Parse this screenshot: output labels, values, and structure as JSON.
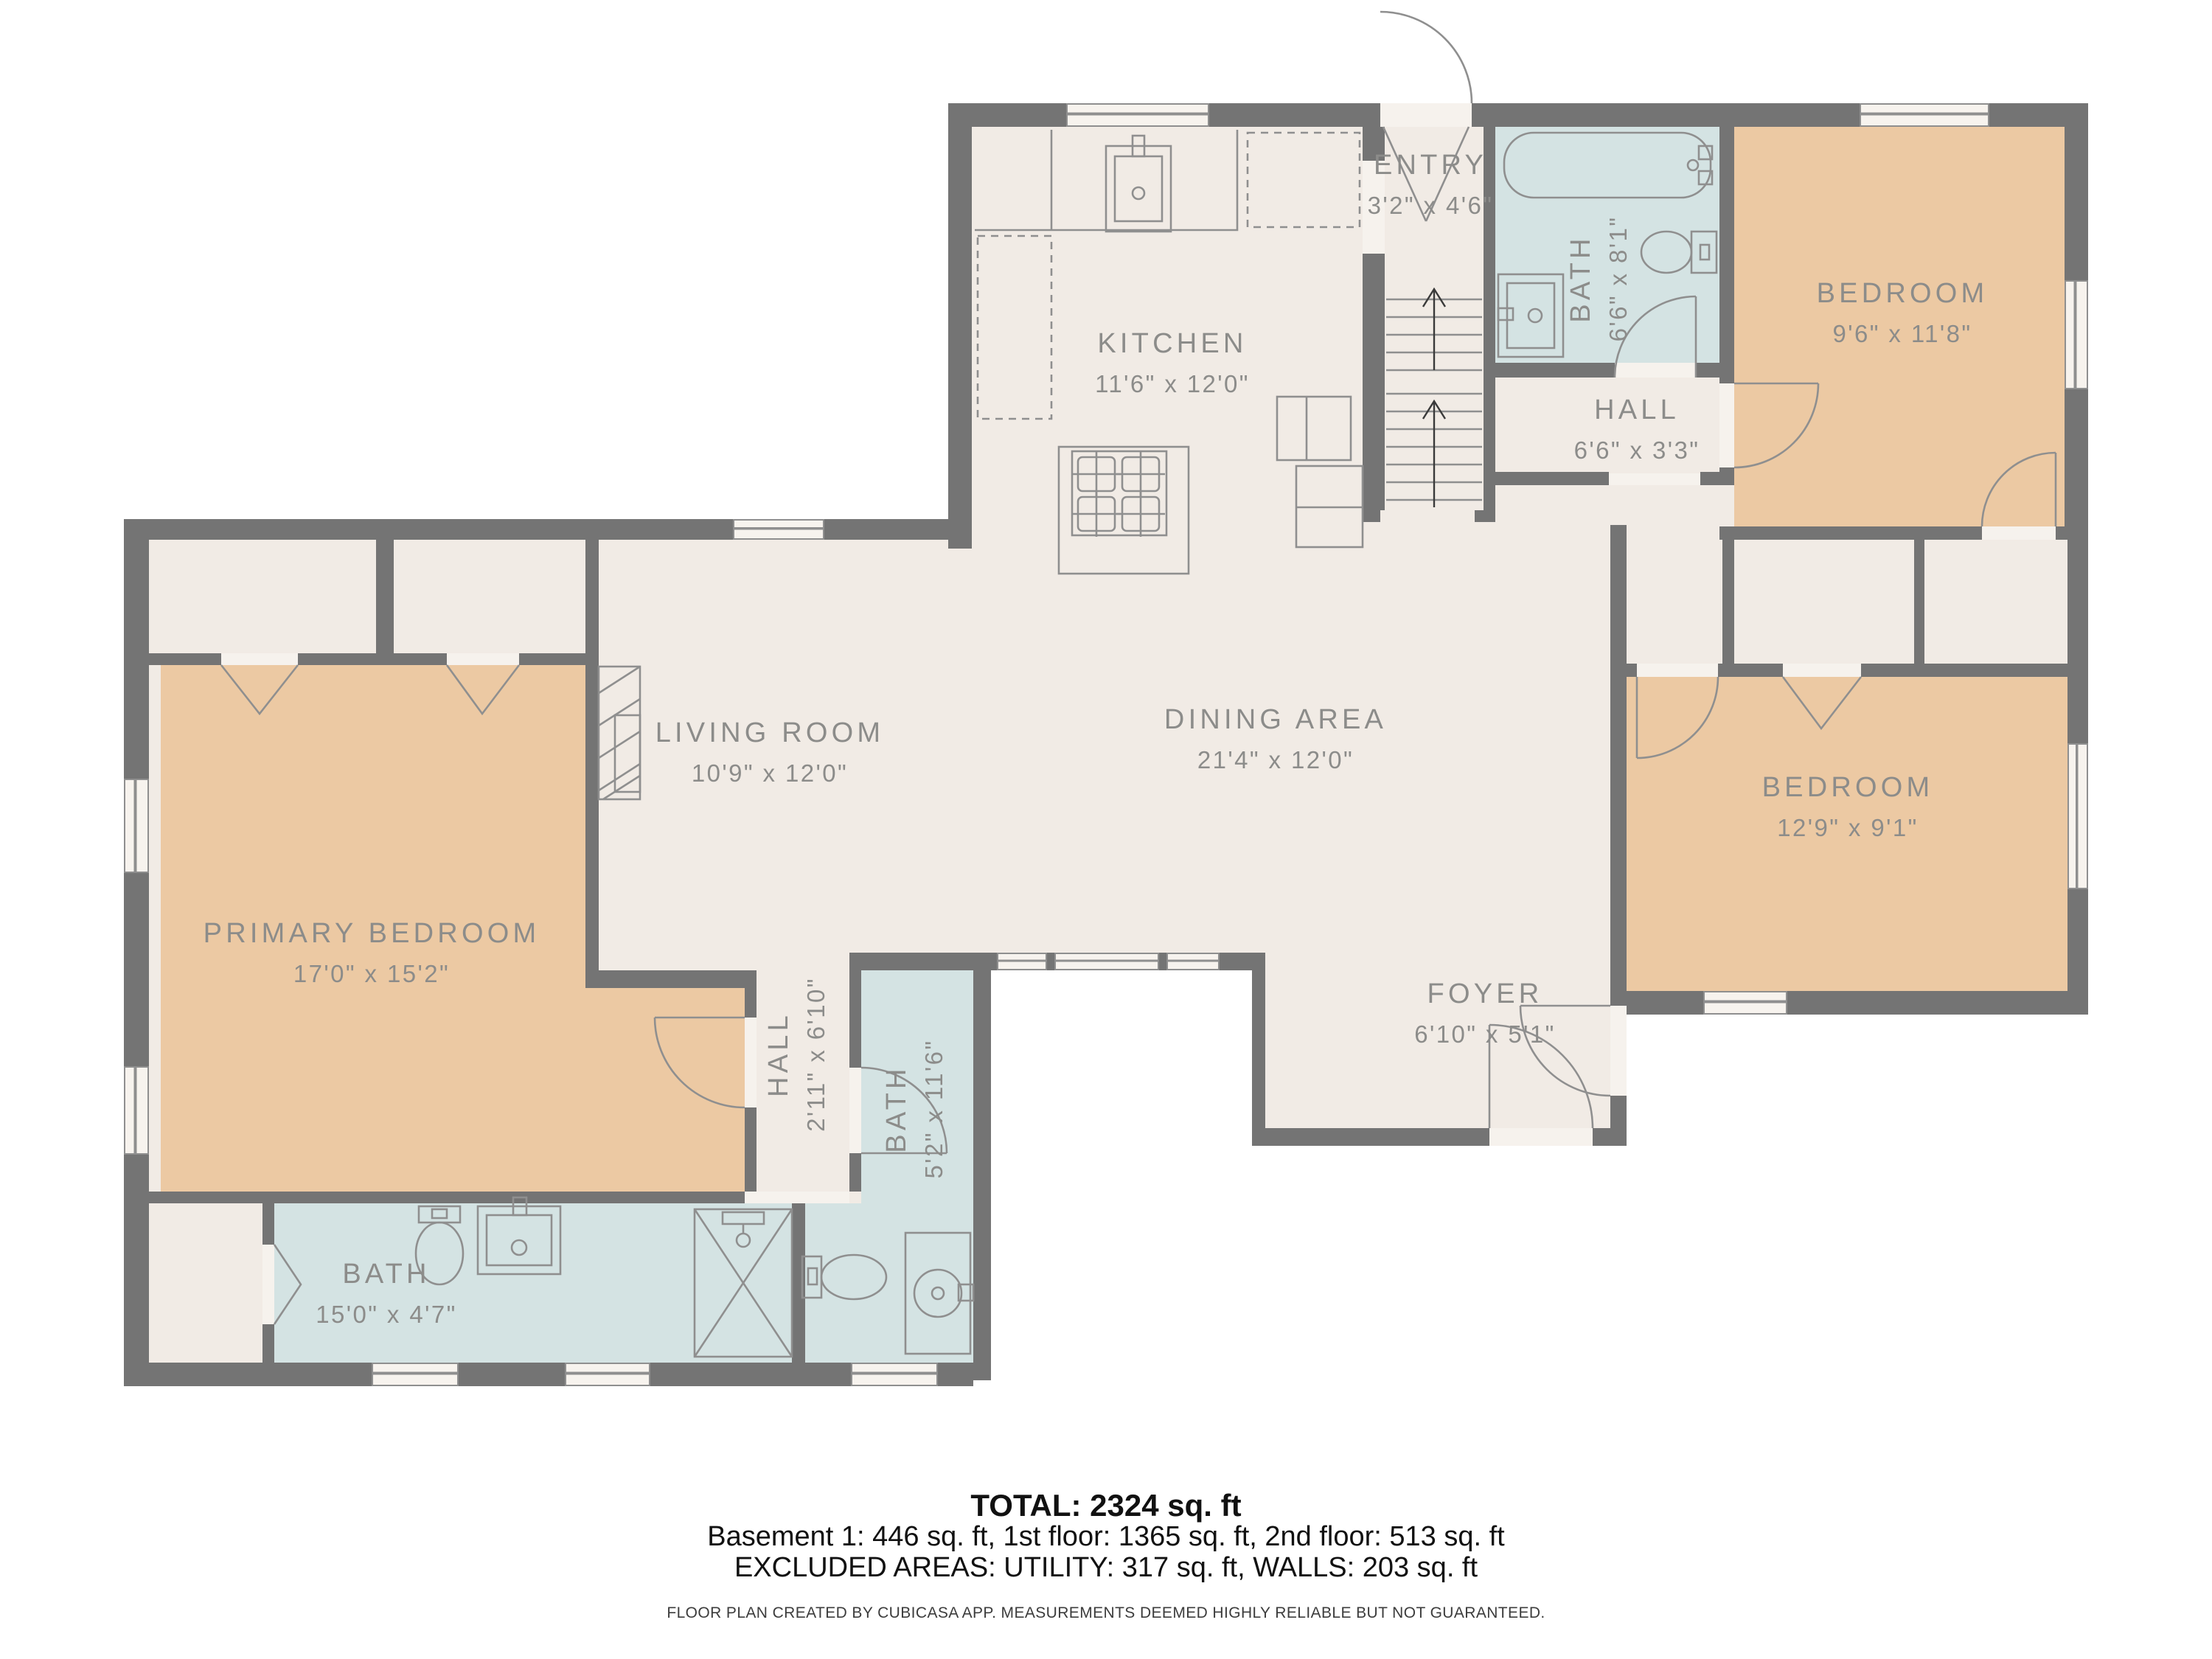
{
  "plan": {
    "rooms": {
      "kitchen": {
        "name": "KITCHEN",
        "dims": "11'6\" x 12'0\""
      },
      "entry": {
        "name": "ENTRY",
        "dims": "3'2\" x 4'6\""
      },
      "bath1": {
        "name": "BATH",
        "dims": "6'6\" x 8'1\""
      },
      "hall1": {
        "name": "HALL",
        "dims": "6'6\" x 3'3\""
      },
      "bedroom1": {
        "name": "BEDROOM",
        "dims": "9'6\" x 11'8\""
      },
      "living": {
        "name": "LIVING ROOM",
        "dims": "10'9\" x 12'0\""
      },
      "dining": {
        "name": "DINING AREA",
        "dims": "21'4\" x 12'0\""
      },
      "primary": {
        "name": "PRIMARY BEDROOM",
        "dims": "17'0\" x 15'2\""
      },
      "bedroom2": {
        "name": "BEDROOM",
        "dims": "12'9\" x 9'1\""
      },
      "foyer": {
        "name": "FOYER",
        "dims": "6'10\" x 5'1\""
      },
      "hall2": {
        "name": "HALL",
        "dims": "2'11\" x 6'10\""
      },
      "bath2": {
        "name": "BATH",
        "dims": "5'2\" x 11'6\""
      },
      "bath3": {
        "name": "BATH",
        "dims": "15'0\" x 4'7\""
      }
    },
    "colors": {
      "wall": "#747474",
      "floor": "#f1ebe5",
      "bedroom_fill": "#ecc9a3",
      "bath_fill": "#d4e3e3",
      "label_text": "#8c8c8a",
      "fixture_stroke": "#8f8f8f"
    }
  },
  "footer": {
    "total": "TOTAL: 2324 sq. ft",
    "floors": "Basement 1: 446 sq. ft, 1st floor: 1365 sq. ft, 2nd floor: 513 sq. ft",
    "excluded": "EXCLUDED AREAS: UTILITY: 317 sq. ft, WALLS: 203 sq. ft",
    "disclaimer": "FLOOR PLAN CREATED BY CUBICASA APP. MEASUREMENTS DEEMED HIGHLY RELIABLE BUT NOT GUARANTEED."
  }
}
